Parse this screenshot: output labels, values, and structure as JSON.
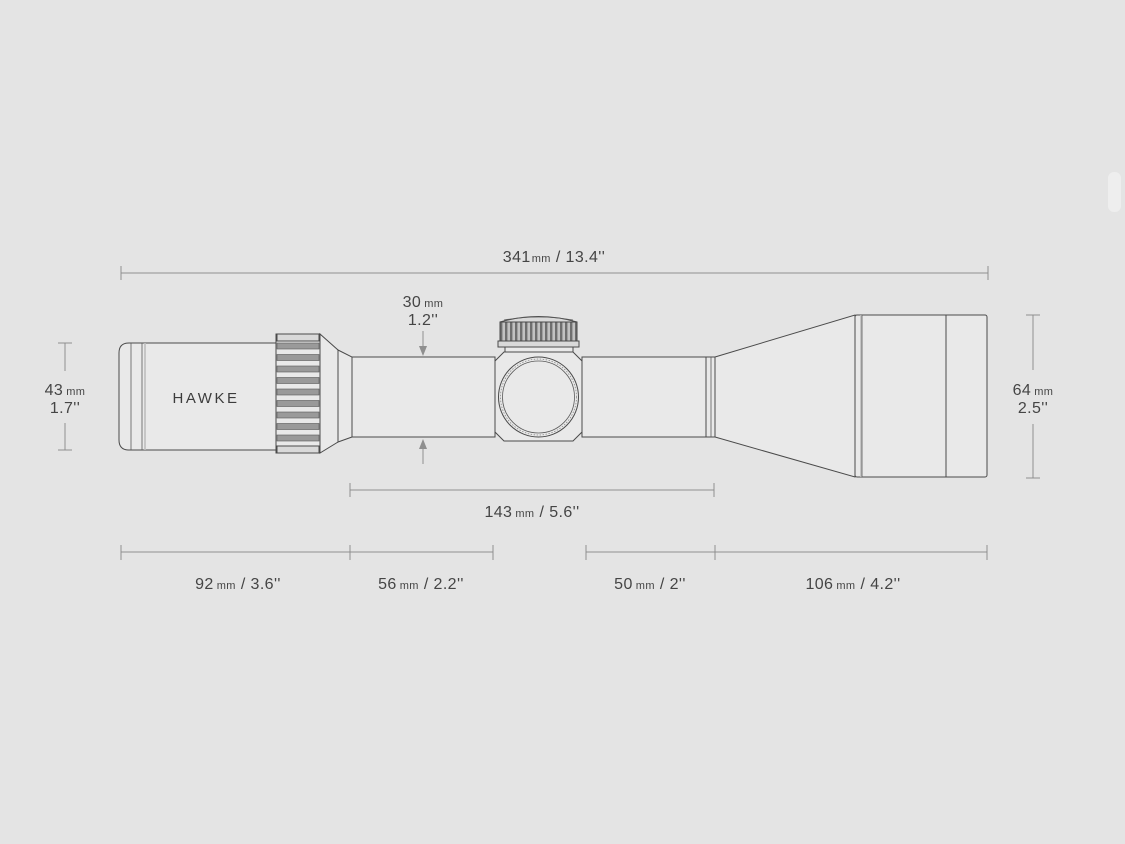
{
  "colors": {
    "background": "#e4e4e4",
    "scope_fill": "#e9e9e9",
    "outline": "#4a4a4a",
    "dimension_lines": "#8f8f8f",
    "text": "#454545"
  },
  "brand": {
    "logo": "HAWKE"
  },
  "dimensions": {
    "total_length": {
      "value": "341",
      "unit": "mm",
      "inches": "/ 13.4''"
    },
    "tube_diameter": {
      "value": "30",
      "unit": "mm",
      "inches": "1.2''"
    },
    "eyepiece_diameter": {
      "value": "43",
      "unit": "mm",
      "inches": "1.7''"
    },
    "objective_diameter": {
      "value": "64",
      "unit": "mm",
      "inches": "2.5''"
    },
    "mid_length": {
      "value": "143",
      "unit": "mm",
      "inches": "/ 5.6''"
    },
    "eyepiece_length": {
      "value": "92",
      "unit": "mm",
      "inches": "/ 3.6''"
    },
    "rear_tube_length": {
      "value": "56",
      "unit": "mm",
      "inches": "/ 2.2''"
    },
    "front_tube_length": {
      "value": "50",
      "unit": "mm",
      "inches": "/ 2''"
    },
    "objective_length": {
      "value": "106",
      "unit": "mm",
      "inches": "/ 4.2''"
    }
  }
}
